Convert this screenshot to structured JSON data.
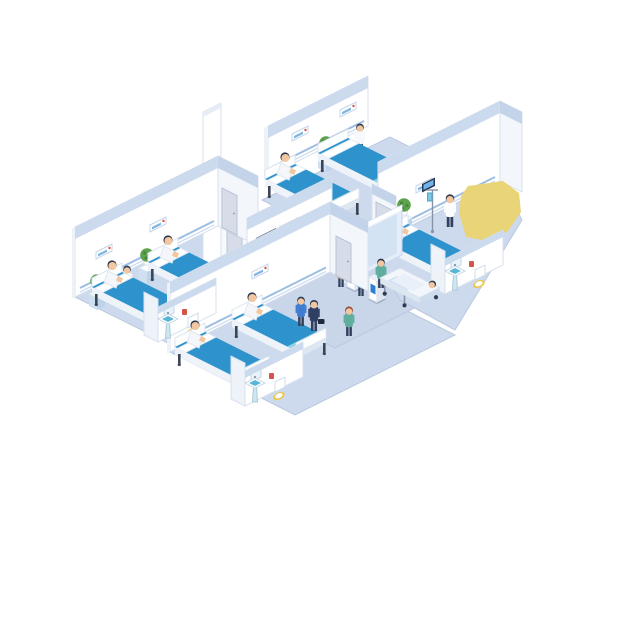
{
  "scene": {
    "description": "Isometric cutaway illustration of a hospital ward floor",
    "style": "flat vector isometric, floating on white",
    "rooms": [
      {
        "name": "ward-upper-left",
        "beds": 2,
        "patients": 2,
        "nurses": 2,
        "plants": 2,
        "bathroom": true
      },
      {
        "name": "ward-lower-left",
        "beds": 2,
        "patients": 2,
        "plants": 2,
        "bathroom": true
      },
      {
        "name": "ward-top",
        "beds": 2,
        "patients": 1,
        "nurses": 1,
        "plants": 1,
        "empty_beds": 1
      },
      {
        "name": "ward-right",
        "beds": 1,
        "patients": 1,
        "doctors": 1,
        "plants": 1,
        "bathroom": true,
        "iv_stand": true
      },
      {
        "name": "lobby",
        "reception_desk": true,
        "wall_displays": 3,
        "self_service_kiosks": 2,
        "visitors": 4,
        "nurses": 1,
        "stretcher": true
      },
      {
        "name": "supply-room",
        "medicine_cabinet": true,
        "staff": 1
      }
    ],
    "people_total": 19,
    "beds_total": 7,
    "highlight": "yellow blob at upper right"
  },
  "colors": {
    "background": "#ffffff",
    "floor": "#cdd9ec",
    "floor_corridor": "#c9d6ea",
    "floor_edge": "#b9c8e0",
    "wall": "#ffffff",
    "wall_shade": "#f3f7fb",
    "wall_cornice": "#ccdaee",
    "wall_cornice_dark": "#c3d3e9",
    "wall_stroke": "#d8e1ee",
    "rail": "#9dbde2",
    "rail_light": "#c6d9ef",
    "bed": "#2e93cc",
    "bed_foot": "#8ad2e2",
    "bed_frame": "#eef3f9",
    "bed_frame_side": "#dde7f2",
    "leg": "#3c4556",
    "pillow": "#ffffff",
    "skin": "#f2c79f",
    "hair": "#2b3850",
    "hair_red": "#9c4a32",
    "white_coat": "#f7f9fc",
    "gown": "#f4f6f9",
    "green_scrubs": "#5fae9d",
    "shirt_blue": "#3f7cd0",
    "shirt_orange": "#e6953f",
    "suit_navy": "#2e3f63",
    "pants": "#32405e",
    "desk_blue": "#1d5da6",
    "desk_band": "#6f9fd6",
    "desk_side": "#164a8c",
    "screen_frame": "#2a3a54",
    "screen_blue": "#2f80d4",
    "screen_pale": "#cfe2f4",
    "glass": "#e4edf8",
    "door": "#d7dde8",
    "plant": "#5ea24e",
    "plant_dark": "#47873b",
    "stand": "#cfe0f1",
    "stand_side": "#bdd3ea",
    "sink_cyan": "#57b7d4",
    "fixture_pale": "#cfe7f0",
    "toilet_seat": "#e9c84e",
    "alert_red": "#d5544a",
    "cabinet_cyan": "#49b4d2",
    "yellow": "#e9d477",
    "metal": "#8a93a6"
  }
}
